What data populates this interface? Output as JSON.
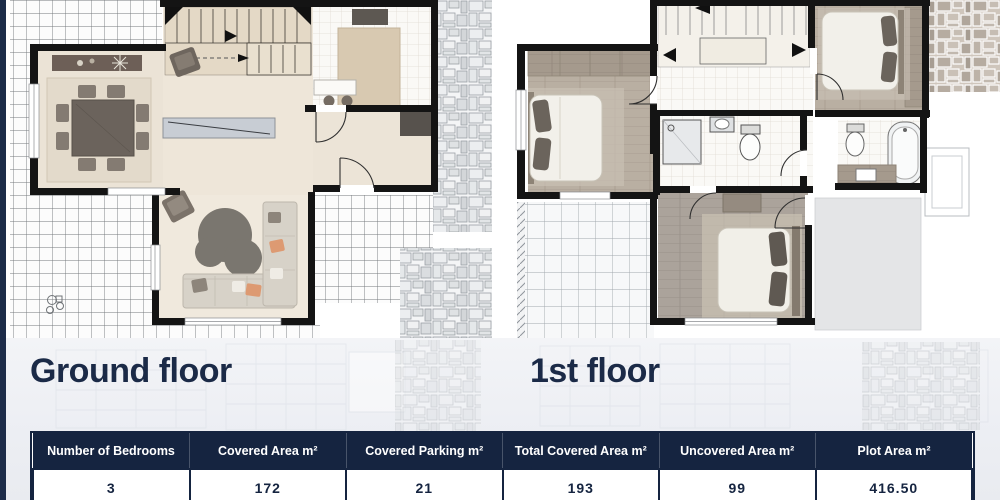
{
  "window": {
    "background": "#ffffff",
    "accent_navy": "#152440",
    "panel_background": "#edeff4",
    "stripe_color": "#1d2c49"
  },
  "floors": [
    {
      "label": "Ground floor"
    },
    {
      "label": "1st floor"
    }
  ],
  "summary_table": {
    "headers": [
      "Number of Bedrooms",
      "Covered Area m²",
      "Covered Parking m²",
      "Total Covered Area m²",
      "Uncovered Area m²",
      "Plot Area m²"
    ],
    "values": [
      "3",
      "172",
      "21",
      "193",
      "99",
      "416.50"
    ]
  }
}
